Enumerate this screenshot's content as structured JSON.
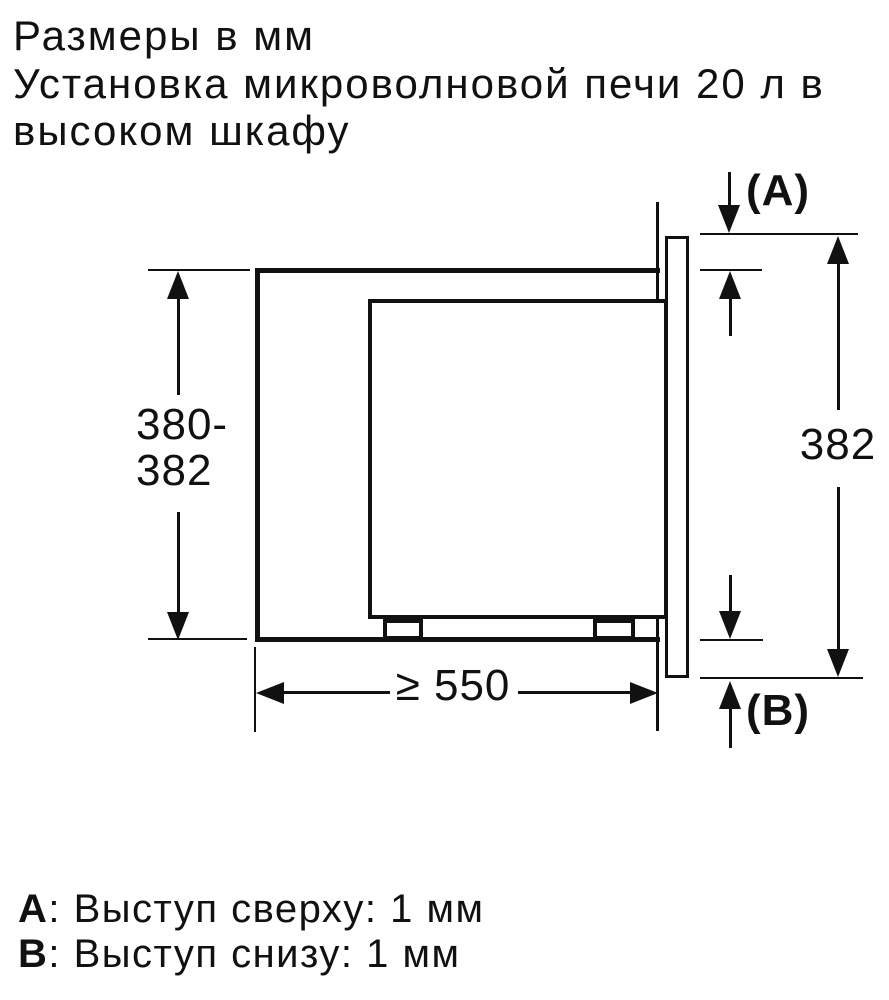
{
  "title": {
    "lines": [
      "Размеры в мм",
      "Установка микроволновой печи 20 л в",
      "высоком шкафу"
    ]
  },
  "dims": {
    "left_line1": "380-",
    "left_line2": "382",
    "right": "382",
    "bottom": "≥ 550",
    "label_a": "(A)",
    "label_b": "(B)"
  },
  "legend": {
    "items": [
      {
        "key": "A",
        "text": ": Выступ сверху: 1 мм"
      },
      {
        "key": "B",
        "text": ": Выступ снизу: 1 мм"
      }
    ]
  },
  "colors": {
    "ink": "#111111",
    "background": "#ffffff"
  }
}
